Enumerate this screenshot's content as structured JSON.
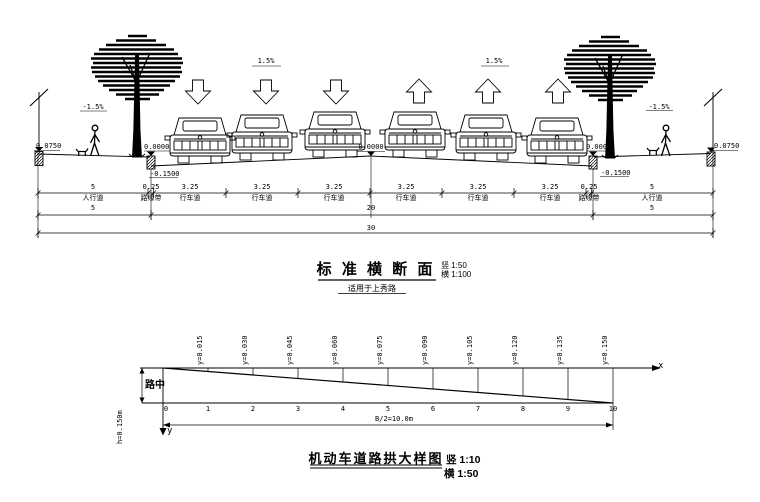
{
  "cross_section": {
    "title": "标 准 横 断 面",
    "subtitle": "适用于上秀路",
    "scale_vertical": "竖 1:50",
    "scale_horizontal": "横 1:100",
    "slope_labels": {
      "left_sidewalk": "-1.5%",
      "left_road": "1.5%",
      "right_road": "1.5%",
      "right_sidewalk": "-1.5%"
    },
    "elevations": {
      "left_outer": "0.0750",
      "left_curb": "0.0000",
      "left_gutter": "-0.1500",
      "center": "0.0000",
      "right_curb": "0.0000",
      "right_gutter": "-0.1500",
      "right_outer": "0.0750"
    },
    "dimensions": {
      "row1": [
        {
          "width": "5",
          "label": "人行道"
        },
        {
          "width": "0.25",
          "label": "路缘带"
        },
        {
          "width": "3.25",
          "label": "行车道"
        },
        {
          "width": "3.25",
          "label": "行车道"
        },
        {
          "width": "3.25",
          "label": "行车道"
        },
        {
          "width": "3.25",
          "label": "行车道"
        },
        {
          "width": "3.25",
          "label": "行车道"
        },
        {
          "width": "3.25",
          "label": "行车道"
        },
        {
          "width": "0.25",
          "label": "路缘带"
        },
        {
          "width": "5",
          "label": "人行道"
        }
      ],
      "row2": [
        "5",
        "20",
        "5"
      ],
      "row3": "30"
    }
  },
  "arch_detail": {
    "title": "机动车道路拱大样图",
    "scale_vertical": "竖 1:10",
    "scale_horizontal": "横 1:50",
    "x_axis_label": "x",
    "y_axis_label": "y",
    "road_center_label": "路中",
    "crown_height_label": "h=0.150m",
    "half_width_label": "B/2=10.0m",
    "stations": [
      "0",
      "1",
      "2",
      "3",
      "4",
      "5",
      "6",
      "7",
      "8",
      "9",
      "10"
    ],
    "ordinates": [
      "y=0.015",
      "y=0.030",
      "y=0.045",
      "y=0.060",
      "y=0.075",
      "y=0.090",
      "y=0.105",
      "y=0.120",
      "y=0.135",
      "y=0.150"
    ]
  }
}
